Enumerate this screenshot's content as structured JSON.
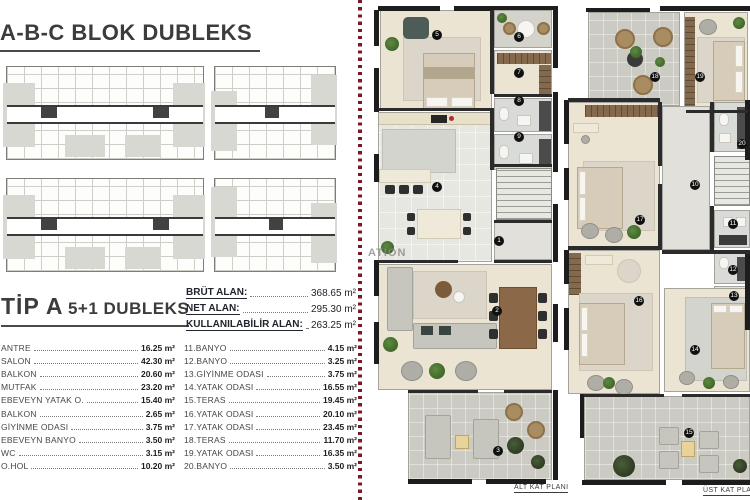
{
  "page": {
    "title": "A-B-C BLOK DUBLEKS",
    "subtitle_main": "TİP A",
    "subtitle_rest": "5+1 DUBLEKS"
  },
  "stats": [
    {
      "label": "BRÜT ALAN:",
      "value": "368.65 m²"
    },
    {
      "label": "NET ALAN:",
      "value": "295.30 m²"
    },
    {
      "label": "KULLANILABİLİR ALAN:",
      "value": "263.25 m²"
    }
  ],
  "rooms_left": [
    {
      "label": "ANTRE",
      "value": "16.25 m²"
    },
    {
      "label": "SALON",
      "value": "42.30 m²"
    },
    {
      "label": "BALKON",
      "value": "20.60 m²"
    },
    {
      "label": "MUTFAK",
      "value": "23.20 m²"
    },
    {
      "label": "EBEVEYN YATAK O.",
      "value": "15.40 m²"
    },
    {
      "label": "BALKON",
      "value": "2.65 m²"
    },
    {
      "label": "GİYİNME ODASI",
      "value": "3.75 m²"
    },
    {
      "label": "EBEVEYN BANYO",
      "value": "3.50 m²"
    },
    {
      "label": "WC",
      "value": "3.15 m²"
    },
    {
      "label": "O.HOL",
      "value": "10.20 m²"
    }
  ],
  "rooms_right": [
    {
      "label": "11.BANYO",
      "value": "4.15 m²"
    },
    {
      "label": "12.BANYO",
      "value": "3.25 m²"
    },
    {
      "label": "13.GİYİNME ODASI",
      "value": "3.75 m²"
    },
    {
      "label": "14.YATAK ODASI",
      "value": "16.55 m²"
    },
    {
      "label": "15.TERAS",
      "value": "19.45 m²"
    },
    {
      "label": "16.YATAK ODASI",
      "value": "20.10 m²"
    },
    {
      "label": "17.YATAK ODASI",
      "value": "23.45 m²"
    },
    {
      "label": "18.TERAS",
      "value": "11.70 m²"
    },
    {
      "label": "19.YATAK ODASI",
      "value": "16.35 m²"
    },
    {
      "label": "20.BANYO",
      "value": "3.50 m²"
    }
  ],
  "plans": {
    "alt": {
      "caption": "ALT KAT PLANI",
      "badges": [
        "5",
        "6",
        "7",
        "8",
        "9",
        "4",
        "1",
        "2",
        "3"
      ]
    },
    "ust": {
      "caption": "ÜST KAT PLANI",
      "badges": [
        "18",
        "19",
        "20",
        "10",
        "11",
        "17",
        "16",
        "12",
        "13",
        "14",
        "15"
      ]
    }
  },
  "watermark": "ATION",
  "colors": {
    "accent_red": "#7c1a22",
    "wall_black": "#1d1d1d",
    "wood_floor": "#ece4d3",
    "tile_gray": "#d3d3cb",
    "terrace_gray": "#cbcbc3",
    "closet_brown": "#84694c"
  }
}
